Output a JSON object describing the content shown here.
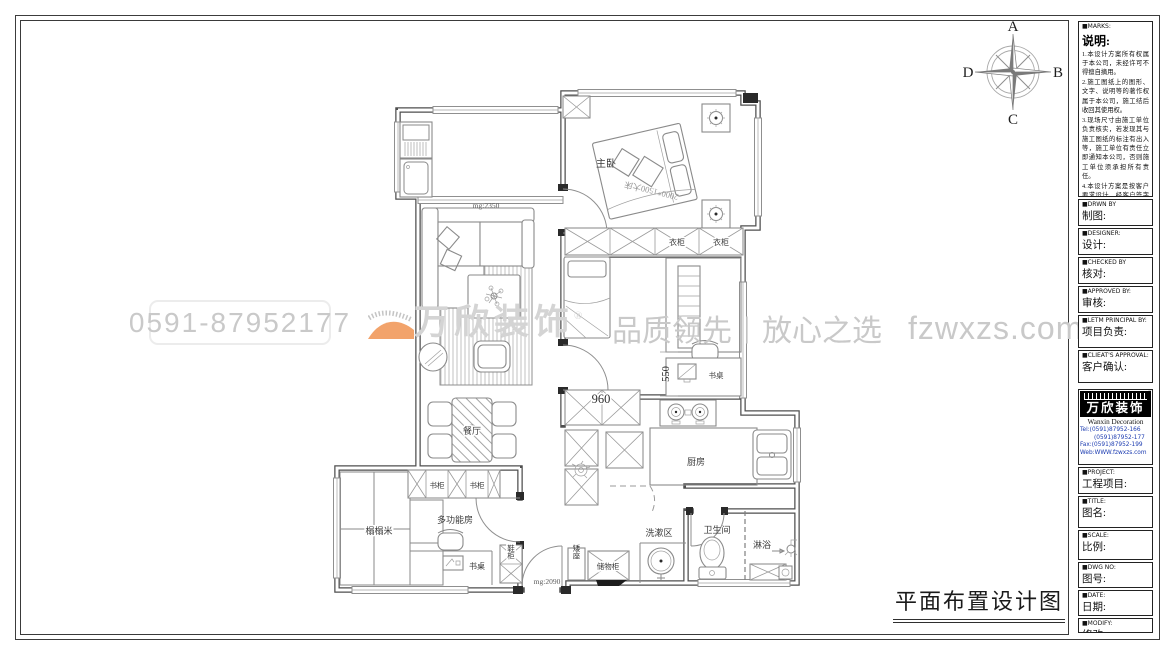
{
  "drawing_title": "平面布置设计图",
  "compass": {
    "top": "A",
    "right": "B",
    "bottom": "C",
    "left": "D"
  },
  "watermark": {
    "phone": "0591-87952177",
    "brand": "万欣装饰",
    "registered": "®",
    "slogan_left": "品质领先",
    "separator": "|",
    "slogan_right": "放心之选",
    "website": "fzwxzs.com"
  },
  "plan": {
    "rooms": {
      "master_bedroom": "主卧",
      "dining": "餐厅",
      "kitchen": "厨房",
      "multi_function": "多功能房",
      "tatami": "榻榻米",
      "wash_area": "洗漱区",
      "bathroom": "卫生间",
      "shower": "淋浴"
    },
    "furniture": {
      "wardrobe_left": "衣柜",
      "wardrobe_right": "衣柜",
      "bookcase_left": "书柜",
      "bookcase_right": "书柜",
      "desk_bedroom": "书桌",
      "desk_multi": "书桌",
      "shoe_cabinet": "鞋柜",
      "low_seat": "矮座",
      "storage_cabinet": "储物柜",
      "bed_spec": "2000*1500大床"
    },
    "dimensions": {
      "passage_width": "mg:2350",
      "entry_width": "mg:2090",
      "cabinet_960": "960",
      "desk_550": "550"
    }
  },
  "titleblock": {
    "marks": {
      "header": "■MARKS:",
      "title": "说明:",
      "notes": [
        "1.本设计方案所有权属于本公司，未经许可不得擅自摘用。",
        "2.施工图纸上的图形、文字、说明等的著作权属于本公司，施工结后收回其使用权。",
        "3.现场尺寸由施工单位负责核实，若发现其与施工图纸的标注有出入等，施工单位有责任立即通知本公司，否则施工单位须承担所有责任。",
        "4.本设计方案是按客户要求设计，经客户签字即视为同意认可，不得随意更改。"
      ]
    },
    "fields_top": [
      {
        "header": "■DRWN BY",
        "label": "制图:"
      },
      {
        "header": "■DESIGNER:",
        "label": "设计:"
      },
      {
        "header": "■CHECKED BY",
        "label": "核对:"
      },
      {
        "header": "■APPROVED BY:",
        "label": "审核:"
      },
      {
        "header": "■LETM PRINCIPAL BY:",
        "label": "项目负责:"
      },
      {
        "header": "■CLIEAT'S APPROVAL:",
        "label": "客户确认:"
      }
    ],
    "logo": {
      "name": "万欣装饰",
      "name_en": "Wanxin Decoration",
      "registered": "®",
      "tel_line1": "Tel:(0591)87952-166",
      "tel_line2": "(0591)87952-177",
      "fax": "Fax:(0591)87952-199",
      "web": "Web:WWW.fzwxzs.com"
    },
    "fields_bottom": [
      {
        "header": "■PROJECT:",
        "label": "工程项目:"
      },
      {
        "header": "■TITLE:",
        "label": "图名:"
      },
      {
        "header": "■SCALE:",
        "label": "比例:"
      },
      {
        "header": "■DWG NO:",
        "label": "图号:"
      },
      {
        "header": "■DATE:",
        "label": "日期:"
      },
      {
        "header": "■MODIFY:",
        "label": "修改:"
      }
    ]
  },
  "colors": {
    "accent_orange": "#f2a36b",
    "watermark_gray": "#c9c9c9",
    "line_dark": "#3c3c3c"
  }
}
